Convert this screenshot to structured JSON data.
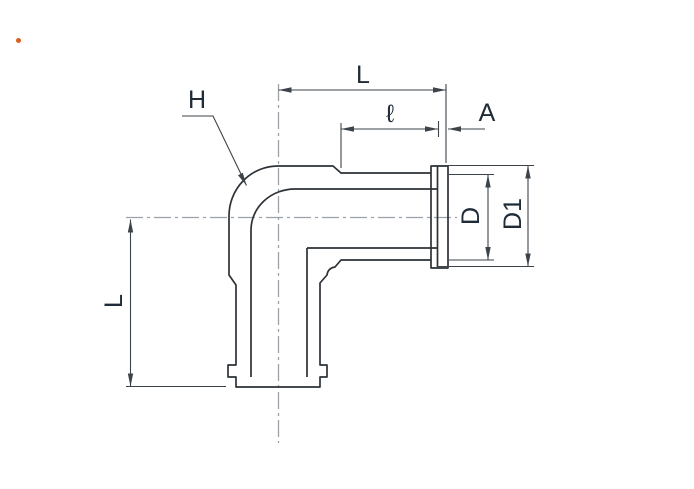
{
  "page": {
    "background": "#ffffff"
  },
  "diagram": {
    "labels": {
      "overall_length_top": "L",
      "thread_length": "ℓ",
      "flange_thickness": "A",
      "bend_reference": "H",
      "diameter": "D",
      "flange_diameter": "D1",
      "overall_length_side": "L"
    },
    "colors": {
      "outline": "#2d3238",
      "dimension_lines": "#3d434a",
      "centerline": "#9ba1a6",
      "label_text": "#202b38",
      "accent_dot": "#d95f1e"
    }
  }
}
